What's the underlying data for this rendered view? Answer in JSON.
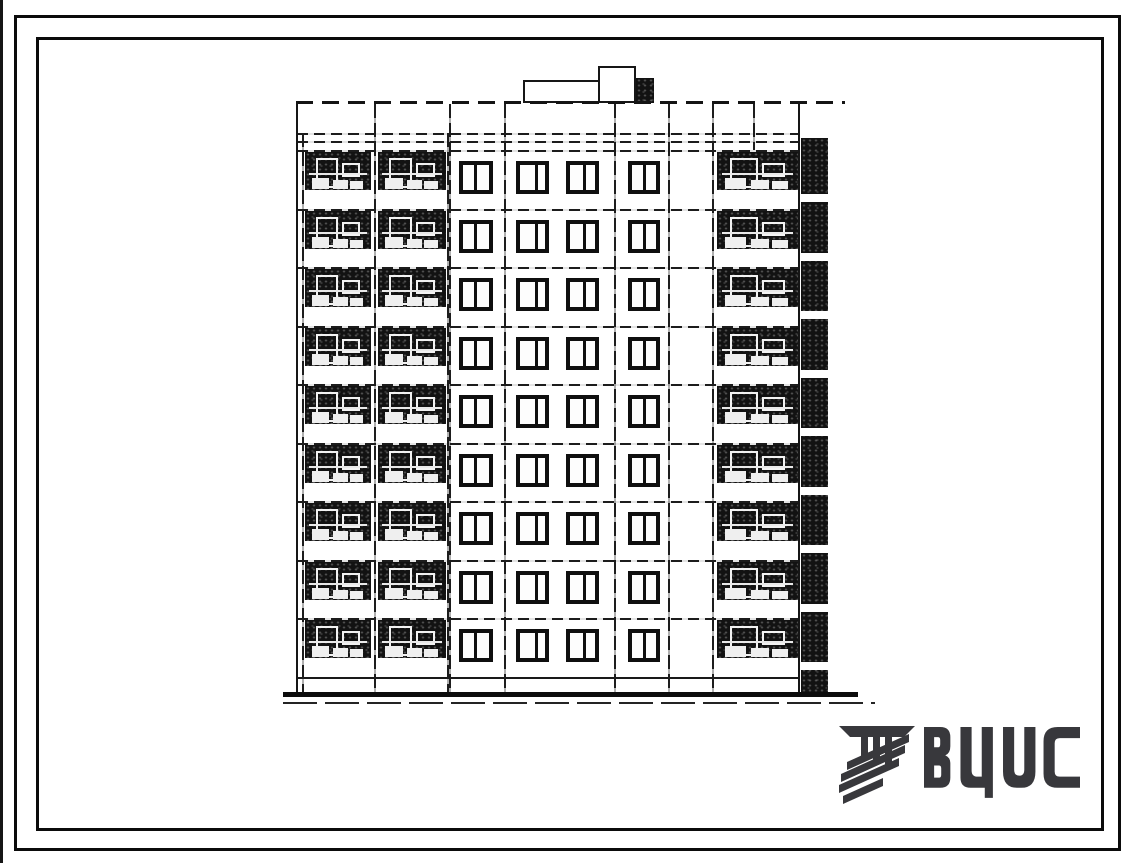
{
  "sheet": {
    "paper_color": "#ffffff",
    "ink_color": "#1a1a1a"
  },
  "logo": {
    "text": "ВЦИС",
    "color": "#38383c",
    "icon": "vcis-mark"
  },
  "elevation": {
    "subject": "nine-storey large-panel apartment building, facade elevation",
    "storeys": 9,
    "windows_per_storey": 4,
    "left_balcony_stacks": 2,
    "right_balcony_stacks": 1,
    "penthouse": true,
    "ink": "#1a1a1a"
  }
}
